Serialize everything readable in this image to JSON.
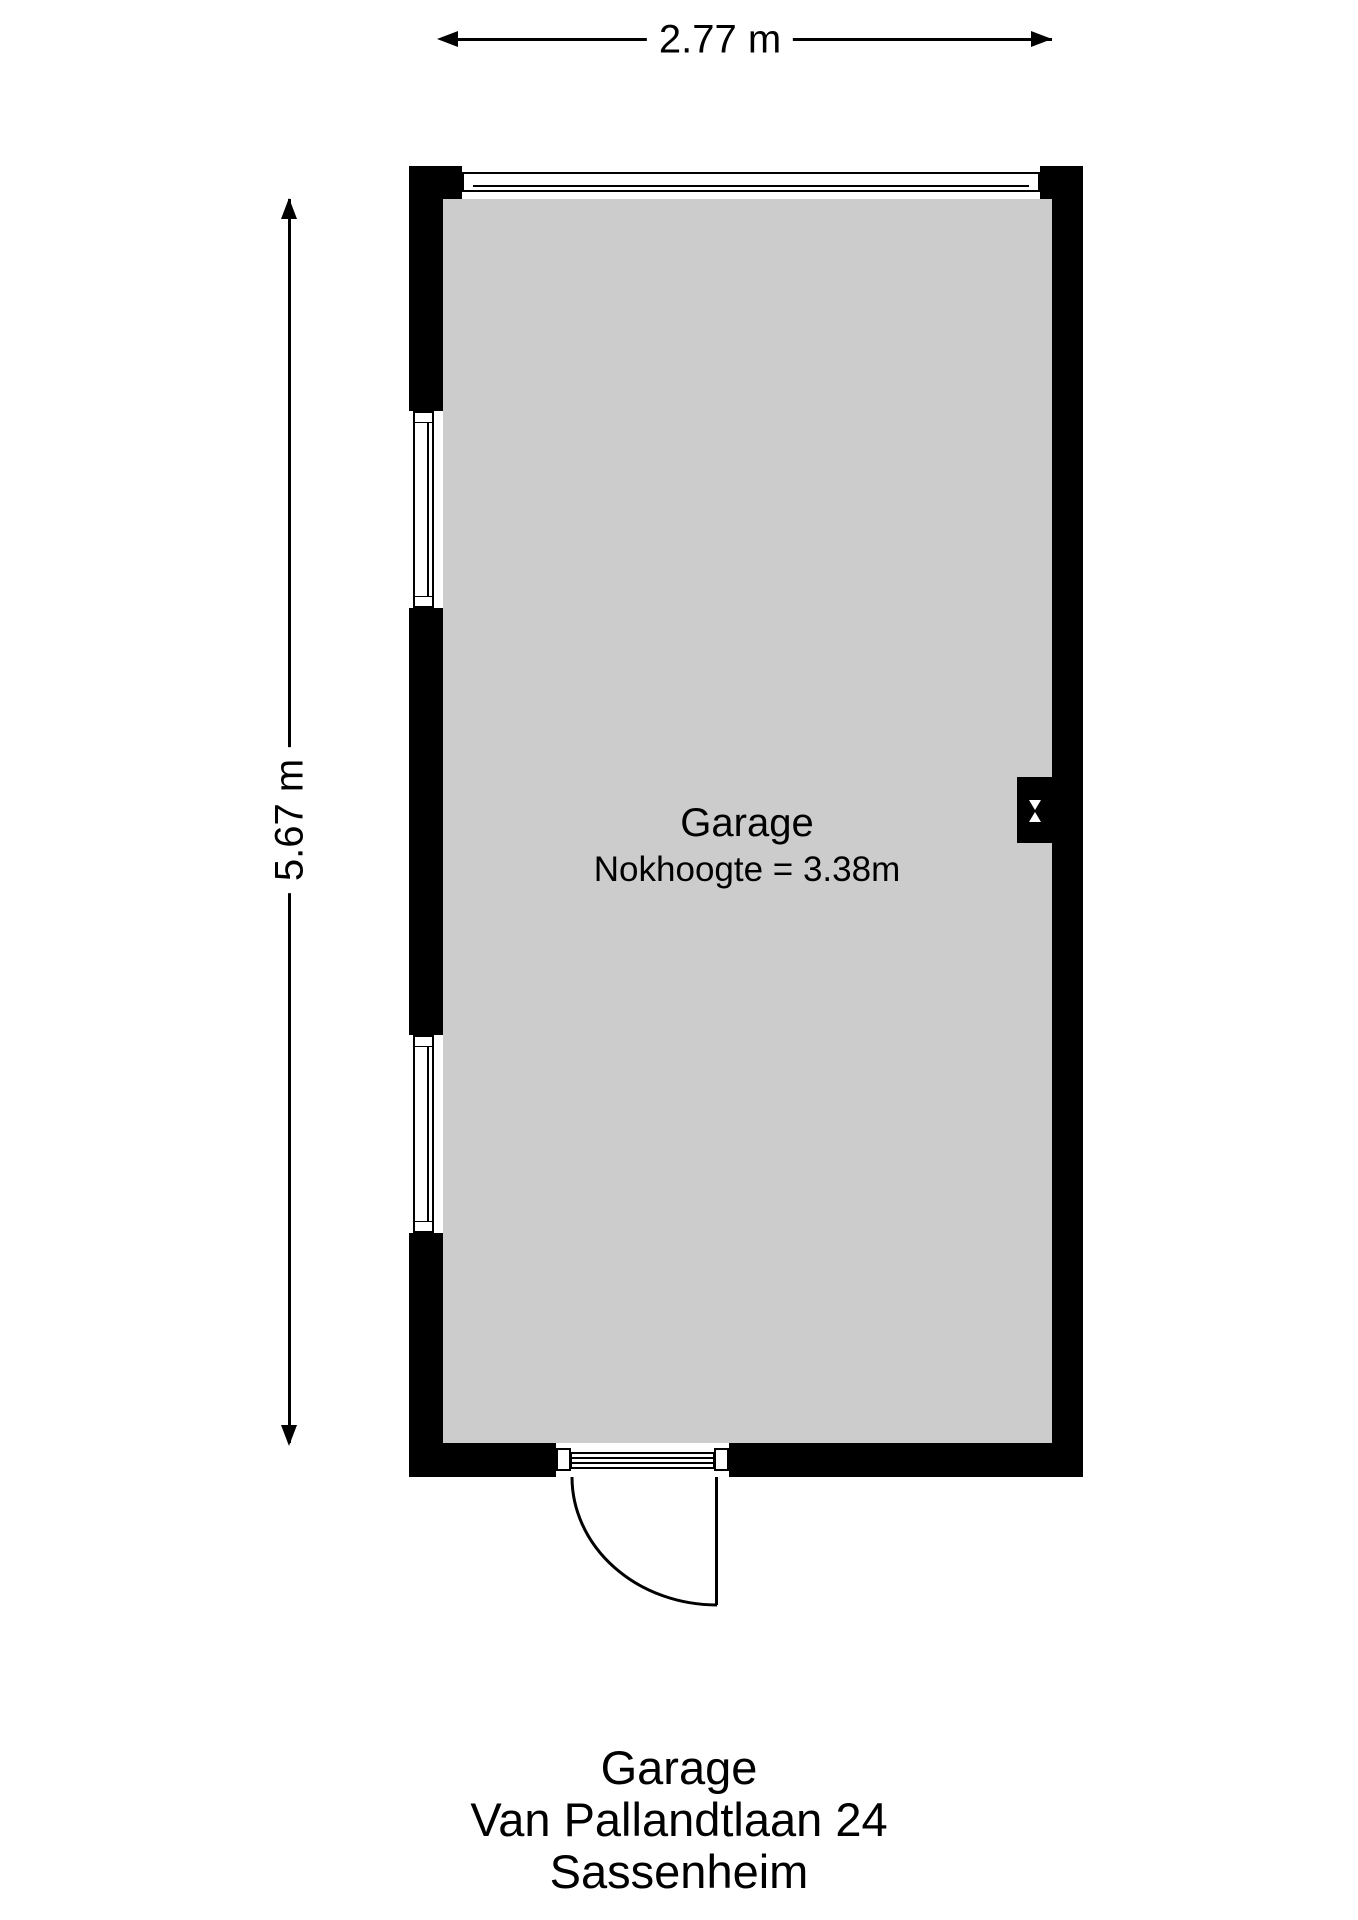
{
  "plan": {
    "room": {
      "name": "Garage",
      "ridge_height_label": "Nokhoogte = 3.38m"
    },
    "dimensions": {
      "width_label": "2.77 m",
      "height_label": "5.67 m"
    },
    "features": {
      "windows": [
        "top-wall-window",
        "left-wall-window-upper",
        "left-wall-window-lower"
      ],
      "door": "bottom-wall-door-outward-swing",
      "vent": "right-wall-flue-box"
    },
    "colors": {
      "wall": "#000000",
      "room_fill": "#cccccc",
      "background": "#ffffff"
    }
  },
  "caption": {
    "title": "Garage",
    "address": "Van Pallandtlaan 24",
    "city": "Sassenheim"
  }
}
